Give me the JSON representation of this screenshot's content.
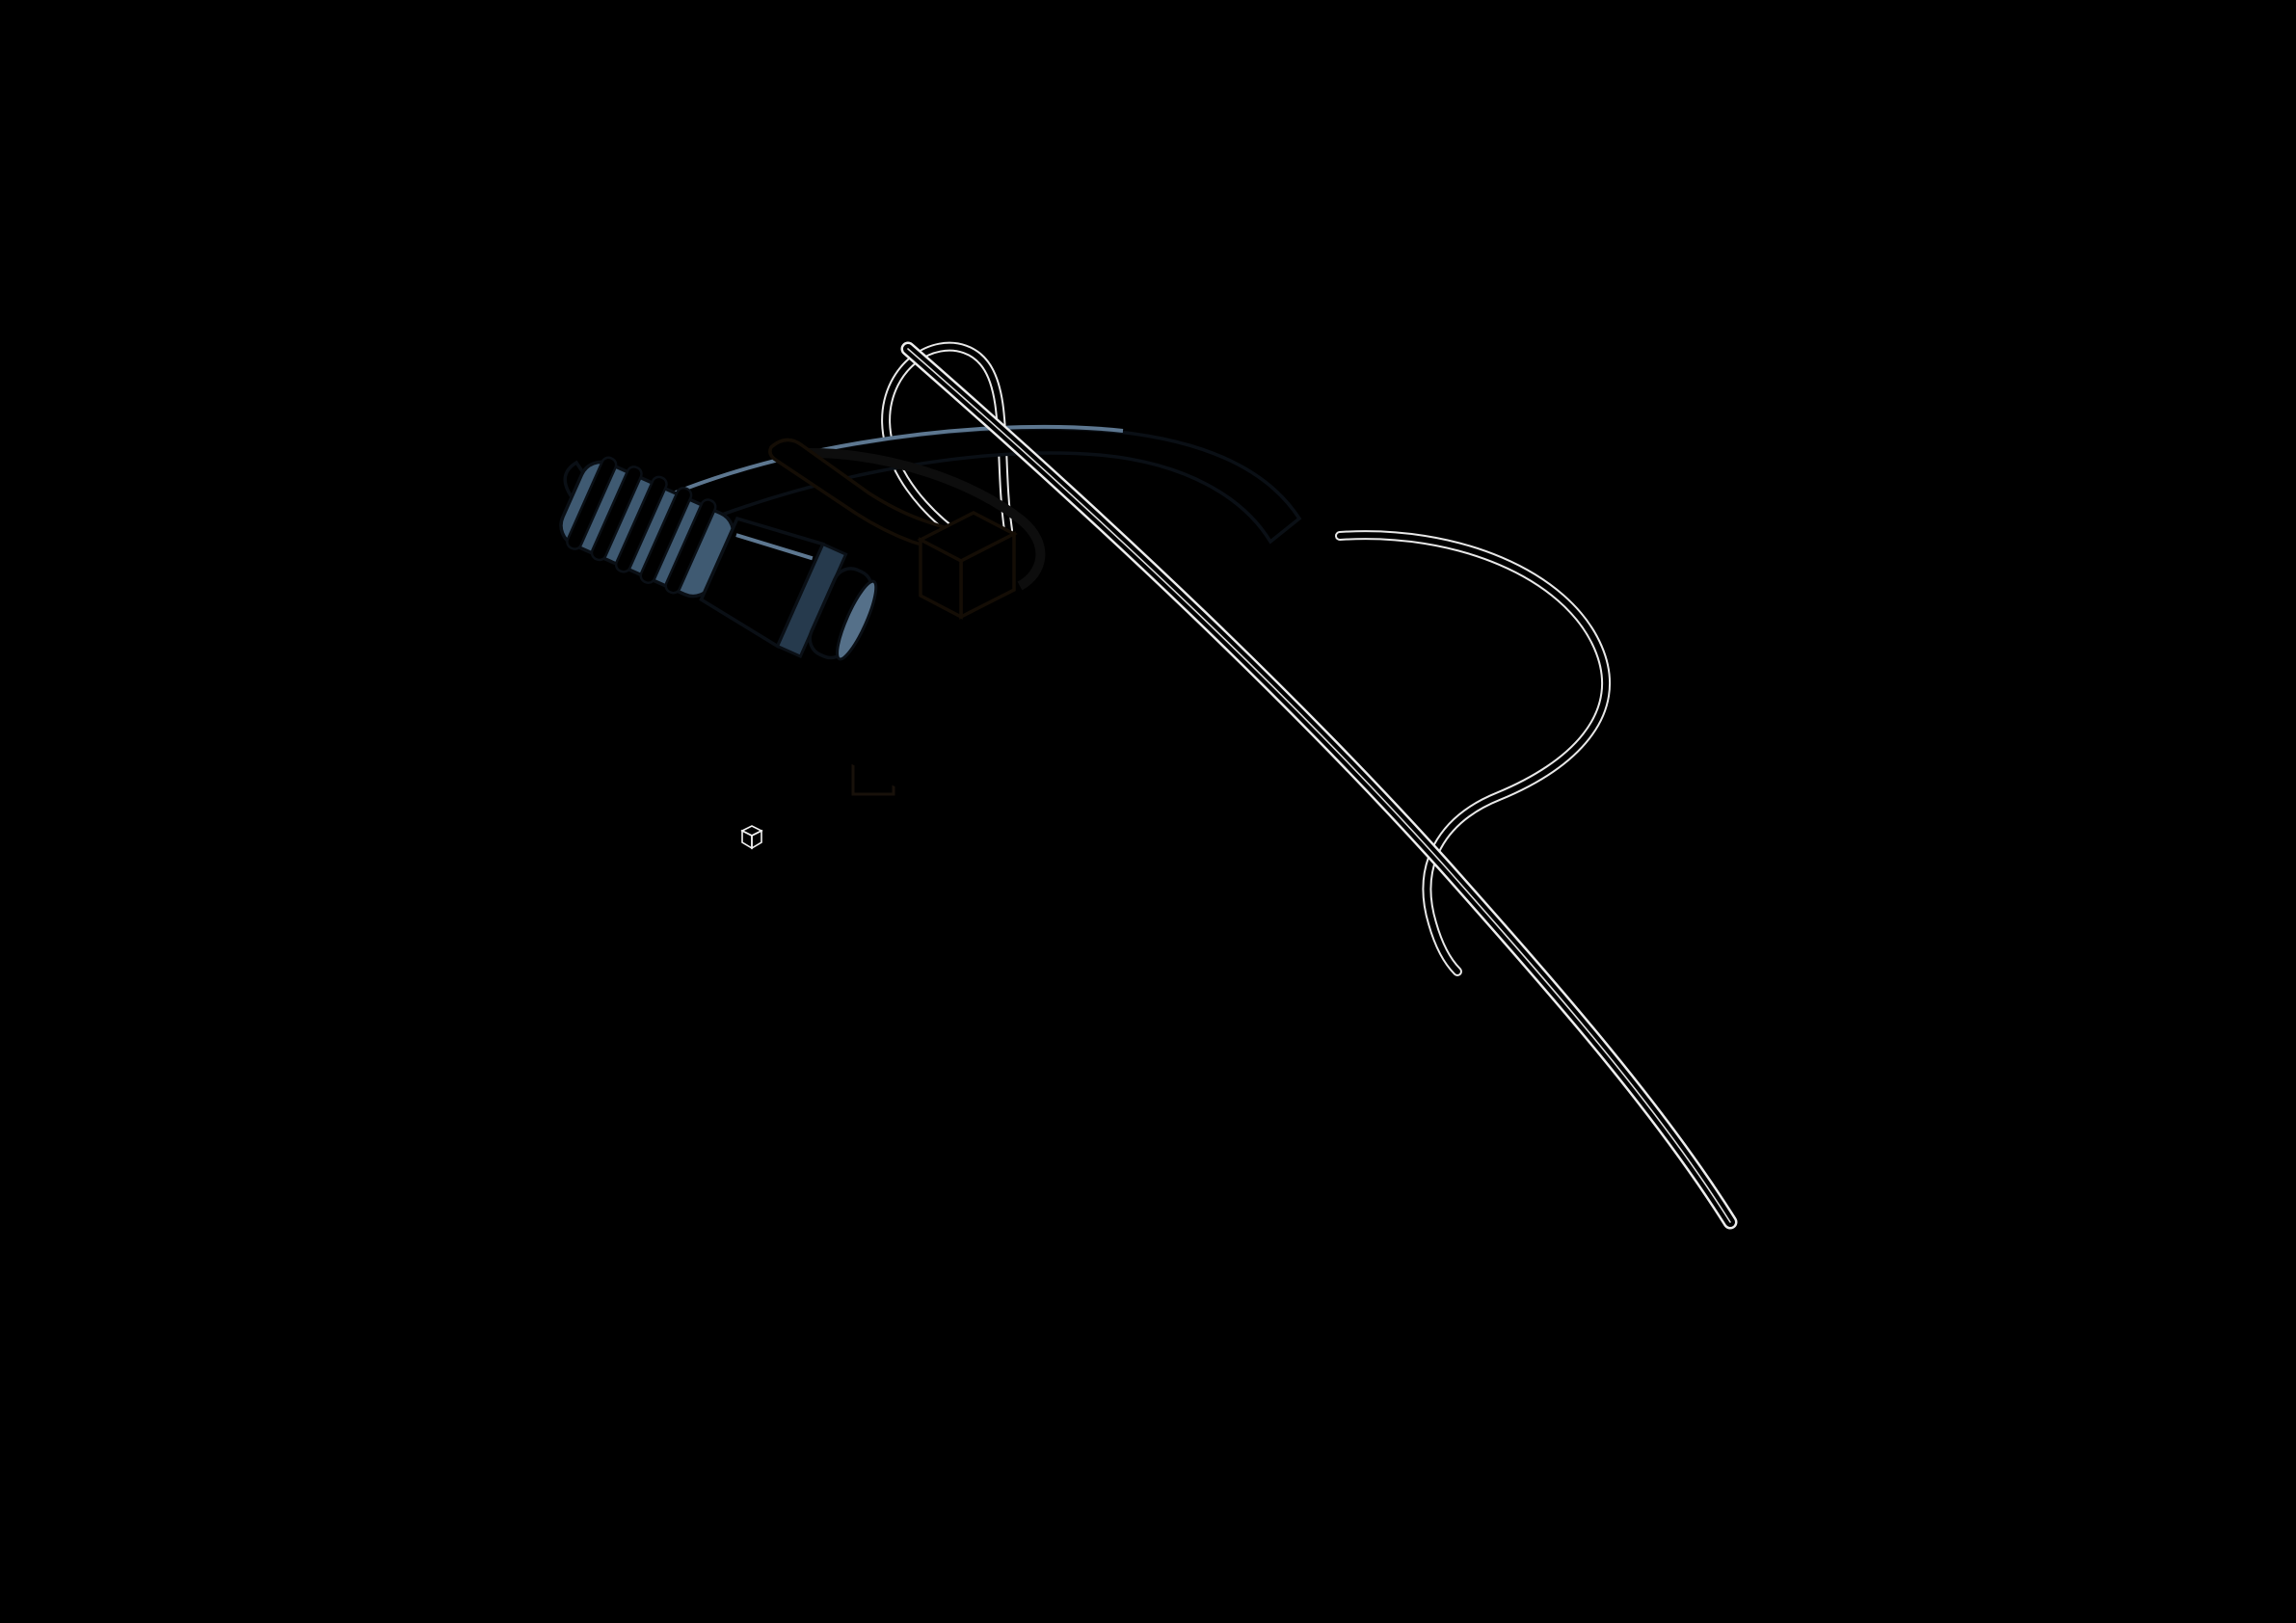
{
  "frame": {
    "top_labels": [
      "1",
      "2",
      "3",
      "4",
      "5",
      "6",
      "7",
      "8"
    ],
    "bottom_labels": [
      "1",
      "2",
      "3",
      "4",
      "5",
      "6",
      "7",
      "8"
    ],
    "left_labels": [
      "A",
      "B",
      "C",
      "D",
      "E",
      "F"
    ],
    "right_labels": [
      "A",
      "B",
      "C",
      "D",
      "E",
      "F"
    ]
  },
  "colors": {
    "background": "#000000",
    "frame_line": "#9e9e9e",
    "ruler_band": "#2c2c2c",
    "ruler_tick": "#0e0e0e",
    "boundary_tick": "#e3e3e3",
    "label_tile": "#7f7f7f",
    "label_text": "#111111",
    "wireframe": "#e8e8e8",
    "wireframe_dim": "#9a9a9a",
    "pcb_fill": "#a0b9cb",
    "pcb_side": "#7d97a9",
    "pcb_outline": "#131a26",
    "standoff_body": "#cf9a5e",
    "standoff_top": "#dcae77",
    "cable_blue": "#46607a",
    "cable_blue_dark": "#2c4154",
    "accent_orange": "#c87f2f",
    "accent_orange_dark": "#a9661f"
  }
}
